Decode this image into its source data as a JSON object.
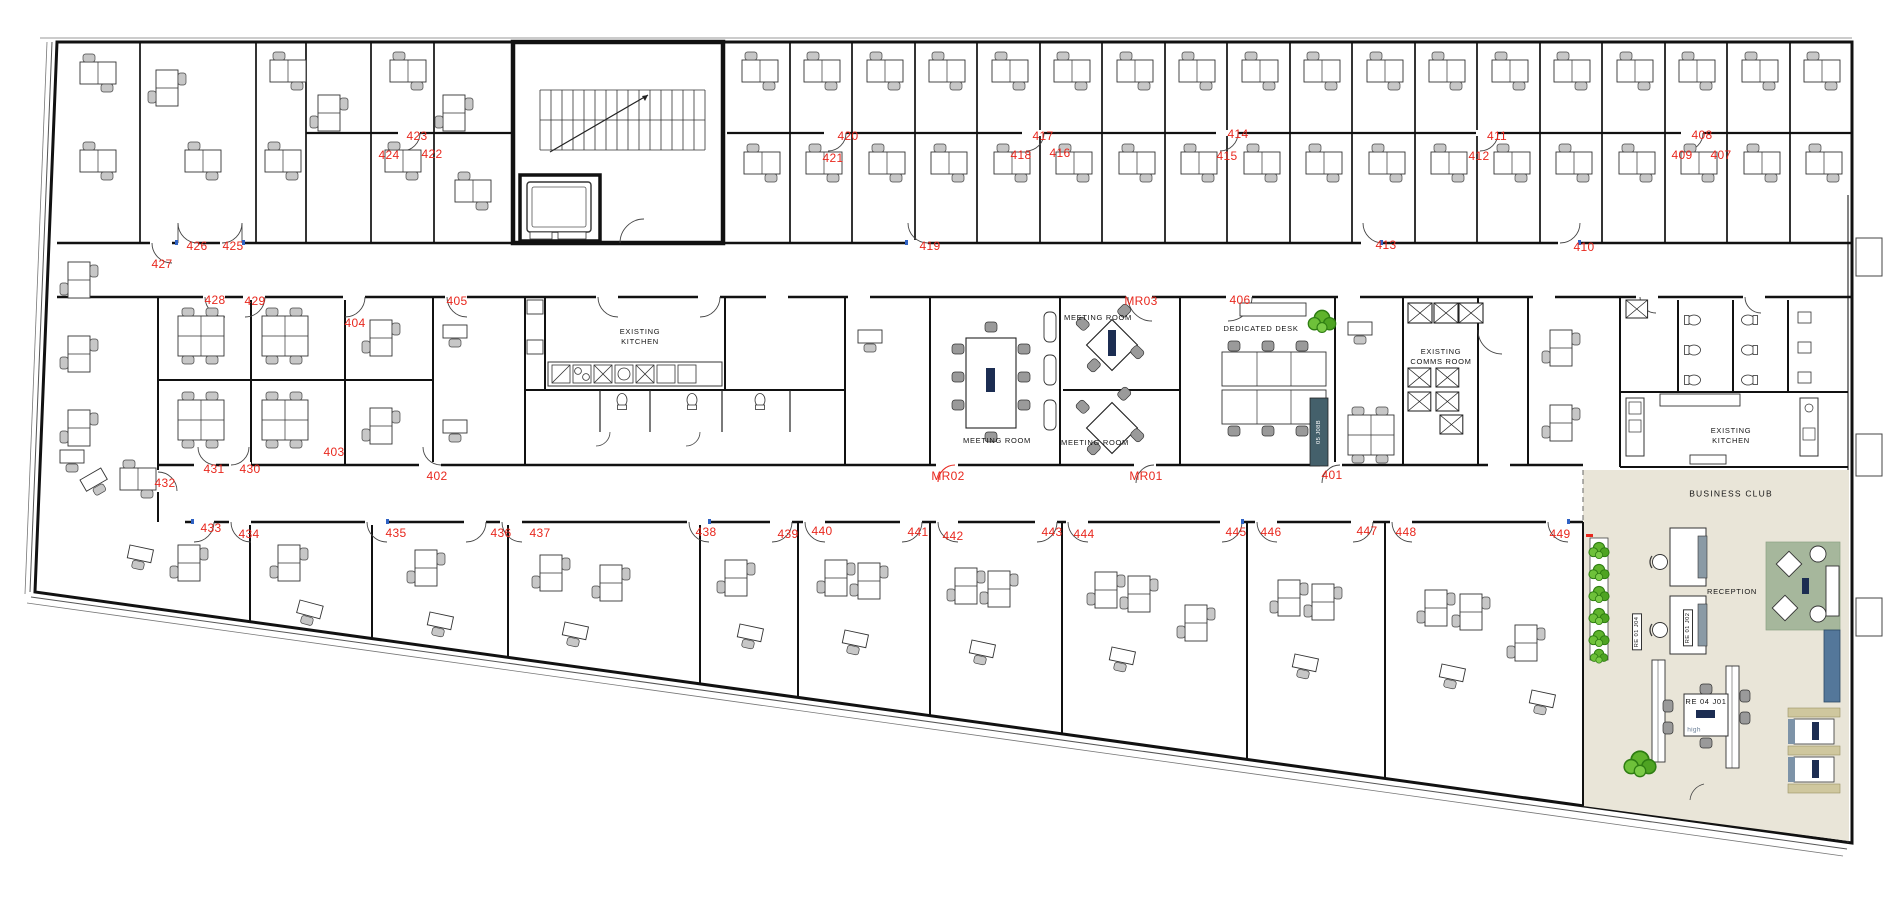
{
  "plan": {
    "colors": {
      "wall": "#111111",
      "label_red": "#e8281e",
      "club_floor": "#e9e5d8",
      "rug_green": "#a6b79c",
      "plant_green": "#5fb32c",
      "accent_blue": "#54779a",
      "booth_tan": "#cfc79e",
      "tag_dark": "#44606b"
    },
    "room_labels": [
      {
        "text": "401",
        "x": 1332,
        "y": 475
      },
      {
        "text": "402",
        "x": 437,
        "y": 476
      },
      {
        "text": "403",
        "x": 334,
        "y": 452
      },
      {
        "text": "404",
        "x": 355,
        "y": 323
      },
      {
        "text": "405",
        "x": 457,
        "y": 301
      },
      {
        "text": "406",
        "x": 1240,
        "y": 300
      },
      {
        "text": "407",
        "x": 1721,
        "y": 155
      },
      {
        "text": "408",
        "x": 1702,
        "y": 135
      },
      {
        "text": "409",
        "x": 1682,
        "y": 155
      },
      {
        "text": "410",
        "x": 1584,
        "y": 247
      },
      {
        "text": "411",
        "x": 1497,
        "y": 136
      },
      {
        "text": "412",
        "x": 1479,
        "y": 156
      },
      {
        "text": "413",
        "x": 1386,
        "y": 245
      },
      {
        "text": "414",
        "x": 1238,
        "y": 134
      },
      {
        "text": "415",
        "x": 1227,
        "y": 156
      },
      {
        "text": "416",
        "x": 1060,
        "y": 153
      },
      {
        "text": "417",
        "x": 1043,
        "y": 136
      },
      {
        "text": "418",
        "x": 1021,
        "y": 155
      },
      {
        "text": "419",
        "x": 930,
        "y": 246
      },
      {
        "text": "420",
        "x": 848,
        "y": 136
      },
      {
        "text": "421",
        "x": 833,
        "y": 158
      },
      {
        "text": "422",
        "x": 432,
        "y": 154
      },
      {
        "text": "423",
        "x": 417,
        "y": 136
      },
      {
        "text": "424",
        "x": 389,
        "y": 155
      },
      {
        "text": "425",
        "x": 233,
        "y": 246
      },
      {
        "text": "426",
        "x": 197,
        "y": 246
      },
      {
        "text": "427",
        "x": 162,
        "y": 264
      },
      {
        "text": "428",
        "x": 215,
        "y": 300
      },
      {
        "text": "429",
        "x": 255,
        "y": 301
      },
      {
        "text": "430",
        "x": 250,
        "y": 469
      },
      {
        "text": "431",
        "x": 214,
        "y": 469
      },
      {
        "text": "432",
        "x": 165,
        "y": 483
      },
      {
        "text": "433",
        "x": 211,
        "y": 528
      },
      {
        "text": "434",
        "x": 249,
        "y": 534
      },
      {
        "text": "435",
        "x": 396,
        "y": 533
      },
      {
        "text": "436",
        "x": 501,
        "y": 533
      },
      {
        "text": "437",
        "x": 540,
        "y": 533
      },
      {
        "text": "438",
        "x": 706,
        "y": 532
      },
      {
        "text": "439",
        "x": 788,
        "y": 534
      },
      {
        "text": "440",
        "x": 822,
        "y": 531
      },
      {
        "text": "441",
        "x": 918,
        "y": 532
      },
      {
        "text": "442",
        "x": 953,
        "y": 536
      },
      {
        "text": "443",
        "x": 1052,
        "y": 532
      },
      {
        "text": "444",
        "x": 1084,
        "y": 534
      },
      {
        "text": "445",
        "x": 1236,
        "y": 532
      },
      {
        "text": "446",
        "x": 1271,
        "y": 532
      },
      {
        "text": "447",
        "x": 1367,
        "y": 531
      },
      {
        "text": "448",
        "x": 1406,
        "y": 532
      },
      {
        "text": "449",
        "x": 1560,
        "y": 534
      },
      {
        "text": "MR01",
        "x": 1146,
        "y": 476
      },
      {
        "text": "MR02",
        "x": 948,
        "y": 476
      },
      {
        "text": "MR03",
        "x": 1141,
        "y": 301
      }
    ],
    "area_labels": [
      {
        "text": "EXISTING\nKITCHEN",
        "x": 640,
        "y": 337
      },
      {
        "text": "MEETING ROOM",
        "x": 1098,
        "y": 318
      },
      {
        "text": "MEETING ROOM",
        "x": 997,
        "y": 441
      },
      {
        "text": "MEETING ROOM",
        "x": 1095,
        "y": 443
      },
      {
        "text": "DEDICATED DESK",
        "x": 1261,
        "y": 329
      },
      {
        "text": "EXISTING\nCOMMS ROOM",
        "x": 1441,
        "y": 357
      },
      {
        "text": "EXISTING\nKITCHEN",
        "x": 1731,
        "y": 436
      },
      {
        "text": "BUSINESS CLUB",
        "x": 1731,
        "y": 494,
        "cls": "big"
      },
      {
        "text": "RECEPTION",
        "x": 1732,
        "y": 592
      },
      {
        "text": "RE 04 J01",
        "x": 1706,
        "y": 702
      },
      {
        "text": "high",
        "x": 1694,
        "y": 731,
        "cls": "muted"
      }
    ],
    "vertical_tags": [
      {
        "text": "RE 01 J04",
        "x": 1637,
        "y": 632,
        "style": "boxed"
      },
      {
        "text": "RE 01 J02",
        "x": 1688,
        "y": 628,
        "style": "boxed"
      },
      {
        "text": "05 J08B",
        "x": 1319,
        "y": 432,
        "style": "dark"
      }
    ]
  }
}
